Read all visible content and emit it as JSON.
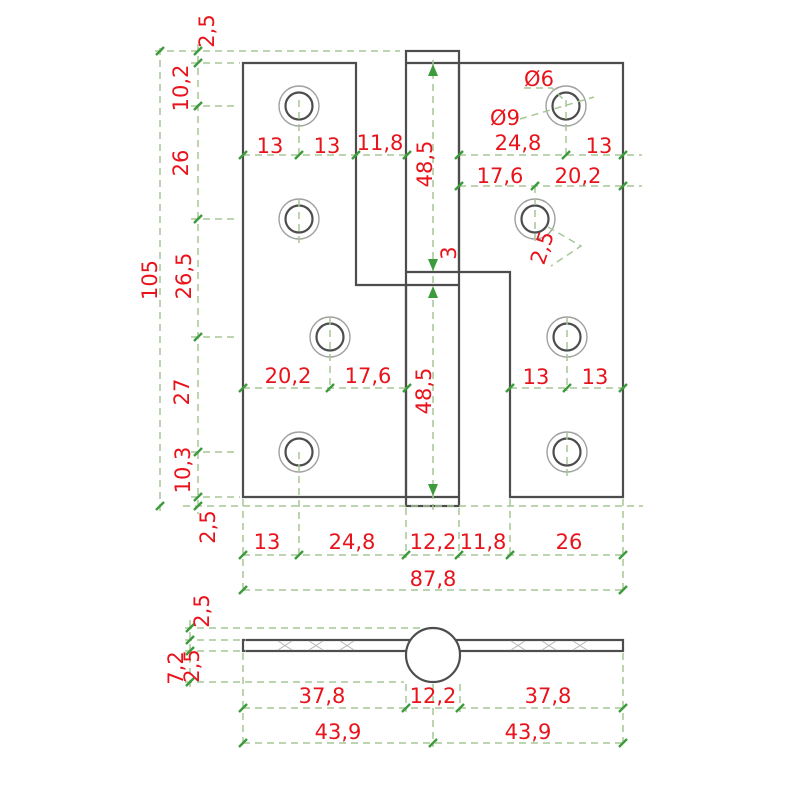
{
  "title": "Hinge technical drawing, front and bottom views",
  "colors": {
    "background": "#ffffff",
    "part_outline": "#4d4d4d",
    "countersink": "#a0a0a0",
    "dimension_line": "#a5c796",
    "tick": "#3c9b3c",
    "dimension_text": "#e8131b"
  },
  "front_view": {
    "left_chain": {
      "seg1": "2,5",
      "seg2": "10,2",
      "seg3": "26",
      "seg4": "26,5",
      "seg5": "27",
      "seg6": "10,3",
      "seg7": "2,5",
      "total": "105"
    },
    "top_row": {
      "left1": "13",
      "left2": "13",
      "left3": "11,8",
      "right1": "24,8",
      "right2": "13"
    },
    "row2_right": {
      "d1": "17,6",
      "d2": "20,2"
    },
    "hole_callouts": {
      "inner_dia": "Ø6",
      "outer_dia": "Ø9",
      "offset": "2,5"
    },
    "center_column": {
      "upper": "48,5",
      "gap": "3",
      "lower": "48,5"
    },
    "mid_row": {
      "left1": "20,2",
      "left2": "17,6",
      "right1": "13",
      "right2": "13"
    },
    "bottom_row": {
      "d1": "13",
      "d2": "24,8",
      "d3": "12,2",
      "d4": "11,8",
      "d5": "26",
      "total": "87,8"
    }
  },
  "bottom_view": {
    "left_chain": {
      "top": "2,5",
      "plate": "2,5",
      "knuckle_drop": "7,2"
    },
    "row1": {
      "d1": "37,8",
      "d2": "12,2",
      "d3": "37,8"
    },
    "row2": {
      "d1": "43,9",
      "d2": "43,9"
    }
  }
}
